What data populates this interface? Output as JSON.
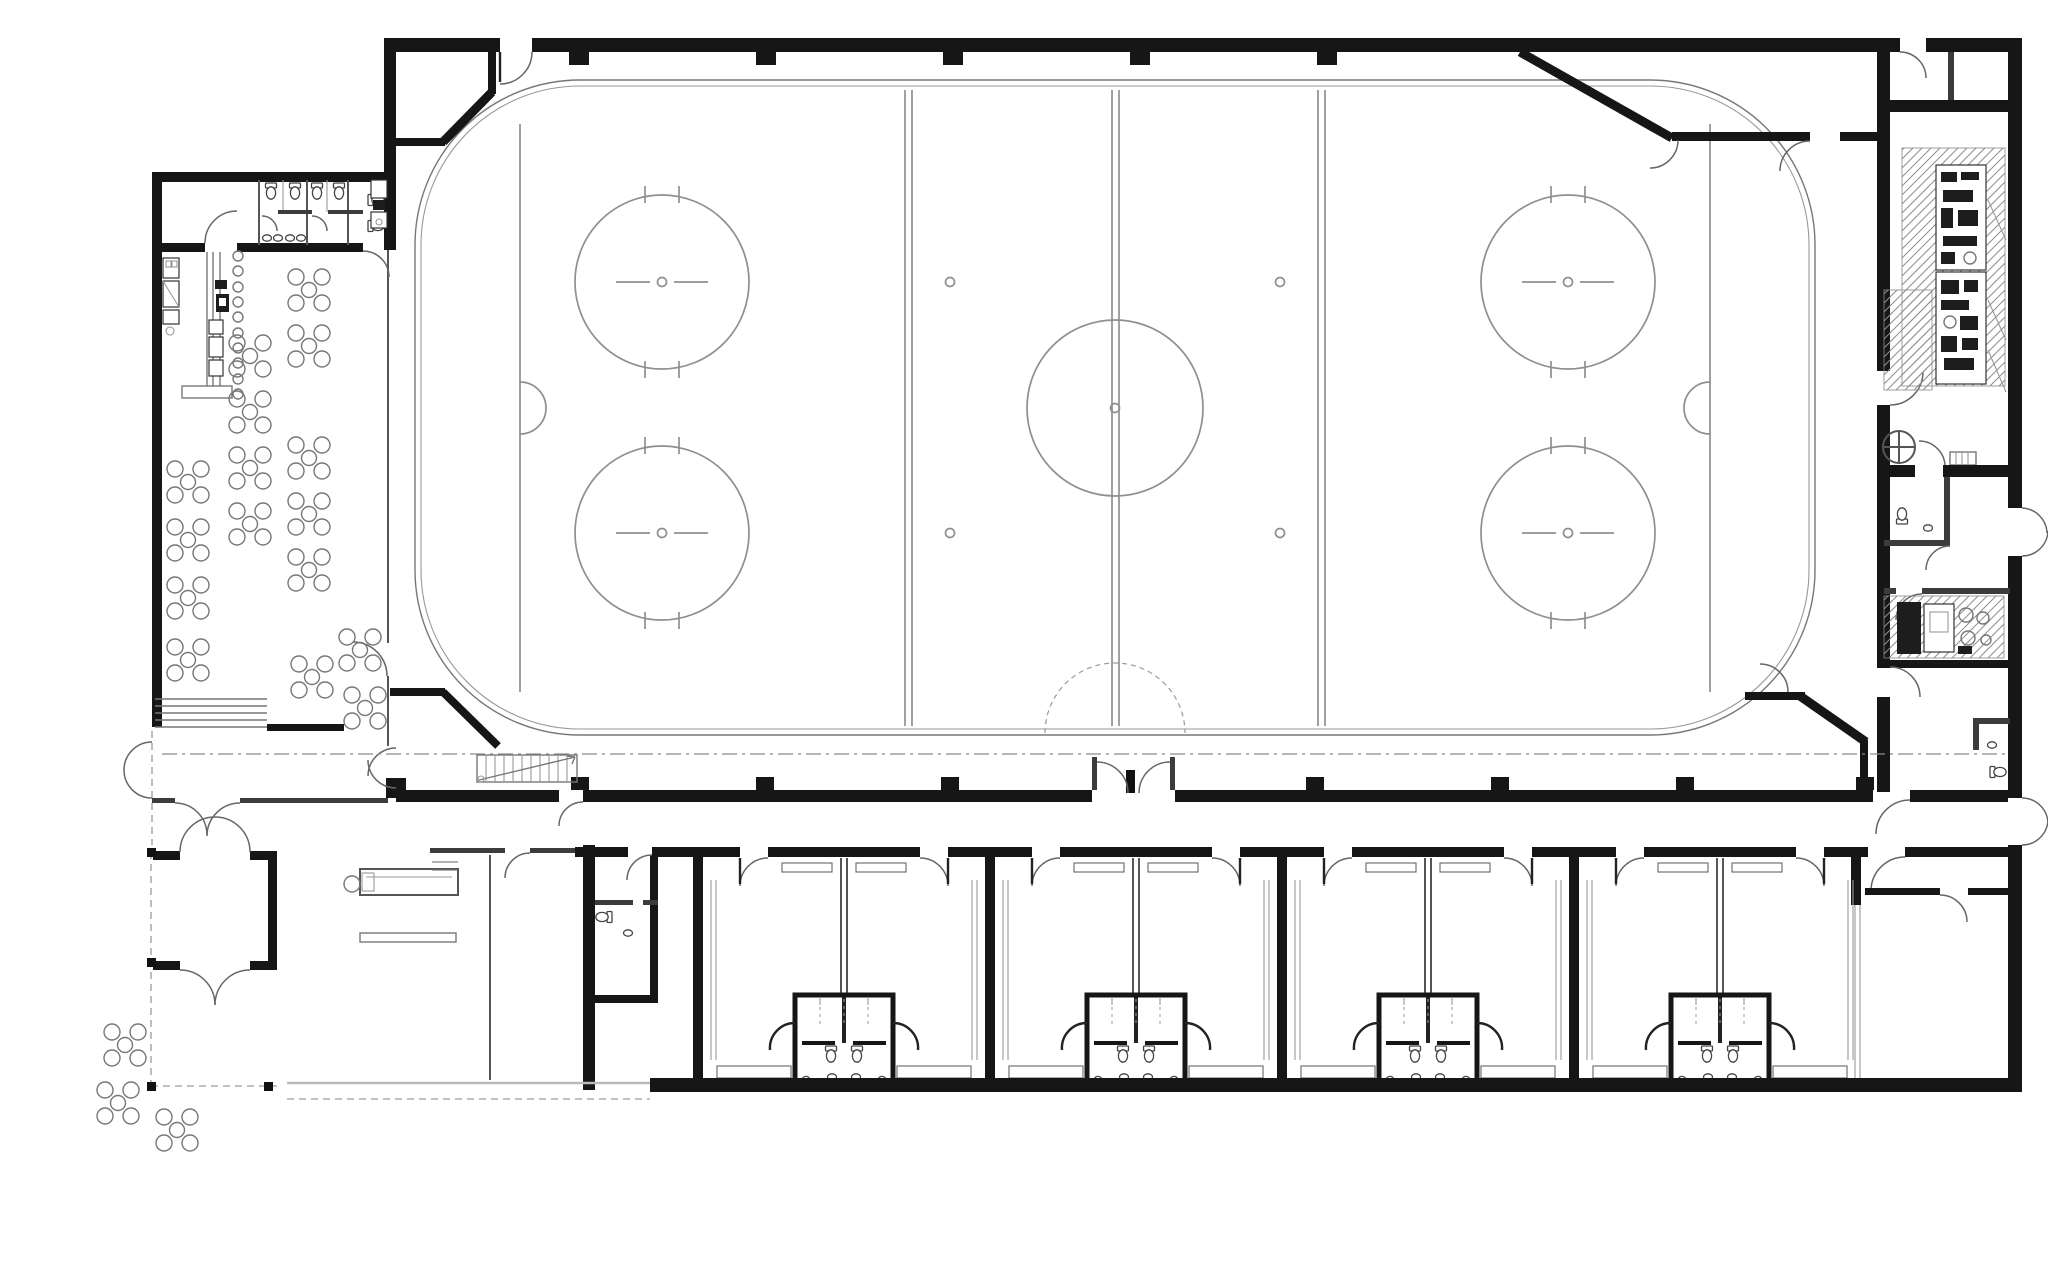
{
  "document": {
    "title": "Ice rink facility — ground floor plan",
    "type": "architectural floor plan",
    "style": "monochrome CAD line drawing on white background"
  },
  "palette": {
    "background": "#ffffff",
    "wall": "#161616",
    "partition": "#3c3c3c",
    "line": "#555555",
    "light_line": "#999999",
    "ice_marking": "#8f8f8f",
    "equipment": "#1d1d1d",
    "dash": "#9a9a9a"
  },
  "spaces": [
    {
      "id": "rink-hall",
      "label": "Arena hall",
      "features": [
        "thick perimeter walls with pilasters",
        "chamfered corner vomitories with doors",
        "stair at south-west corner",
        "roof overhang dash-dot line",
        "double door vestibule in south wall"
      ]
    },
    {
      "id": "ice-rink",
      "label": "Ice hockey rink",
      "markings": [
        "rounded-corner boards drawn as double line",
        "two blue lines (double)",
        "centre line",
        "two goal lines",
        "centre circle with centre spot",
        "four end-zone face-off circles with hash marks and spots",
        "four neutral-zone face-off spots",
        "two goal creases",
        "referee crease at south boards"
      ]
    },
    {
      "id": "restaurant",
      "label": "Restaurant / cafeteria",
      "features": [
        "long bar counter with stools",
        "kitchen units on both walls",
        "entry steps at south-west",
        "glazed wall towards rink"
      ]
    },
    {
      "id": "restrooms",
      "label": "Restaurant WC block with storage room",
      "features": [
        "toilet stalls",
        "wash basins"
      ]
    },
    {
      "id": "entrance",
      "label": "Entrance vestibule, canopy and lobby",
      "features": [
        "double entrance doors",
        "reception desk with chair",
        "canopy columns and dashed roof line",
        "outdoor terrace tables"
      ]
    },
    {
      "id": "corridor",
      "label": "Changing-room corridor",
      "features": [
        "exterior door at east end",
        "door to hall stair"
      ]
    },
    {
      "id": "locker-rooms",
      "label": "Team changing rooms",
      "features": [
        "benches along walls",
        "central shower / WC pods with curved screens"
      ]
    },
    {
      "id": "staff-wc",
      "label": "Corridor WC",
      "features": [
        "toilet",
        "wash basin"
      ]
    },
    {
      "id": "annex",
      "label": "Technical annex",
      "features": [
        "refrigeration plant room with hatched equipment zones",
        "utility room with WC and floor drain",
        "ventilation plant room",
        "store rooms",
        "two exterior doors"
      ]
    },
    {
      "id": "corner-rooms",
      "label": "South-east store rooms"
    }
  ],
  "counts": {
    "restaurant_tables": 16,
    "terrace_tables": 3,
    "bar_stools": 10,
    "locker_room_pairs": 4,
    "shower_pods": 4,
    "faceoff_circles": 4,
    "neutral_zone_spots": 4,
    "top_wall_pilasters": 5,
    "bottom_wall_pilasters": 7
  }
}
